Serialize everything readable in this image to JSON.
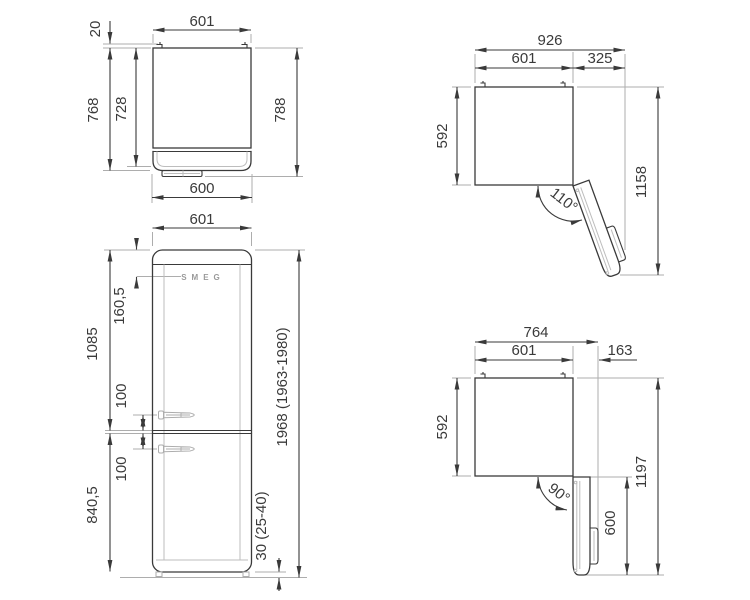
{
  "document": {
    "type": "appliance dimension drawing",
    "product": "refrigerator",
    "background": "#ffffff"
  },
  "colors": {
    "line": "#3a3a3a",
    "extension": "#adadad",
    "logo": "#9a9a9a"
  },
  "views": {
    "top": {
      "label": "top view, door closed",
      "dims": {
        "width": "601",
        "hinge_offset": "20",
        "depth_with_door": "768",
        "depth_body": "728",
        "depth_total": "788",
        "door_width": "600"
      }
    },
    "front": {
      "label": "front view",
      "logo": "SMEG",
      "dims": {
        "width": "601",
        "top_to_logo": "160,5",
        "top_section": "1085",
        "handle_above": "100",
        "handle_below": "100",
        "bottom_section": "840,5",
        "total_height": "1968 (1963-1980)",
        "feet_height": "30 (25-40)"
      }
    },
    "open110": {
      "label": "top view, door open 110°",
      "dims": {
        "total_width": "926",
        "body_width": "601",
        "door_projection": "325",
        "body_depth": "592",
        "total_depth": "1158",
        "opening_angle": "110°"
      }
    },
    "open90": {
      "label": "top view, door open 90°",
      "dims": {
        "total_width": "764",
        "body_width": "601",
        "door_projection": "163",
        "body_depth": "592",
        "total_depth": "1197",
        "door_length": "600",
        "opening_angle": "90°"
      }
    }
  }
}
